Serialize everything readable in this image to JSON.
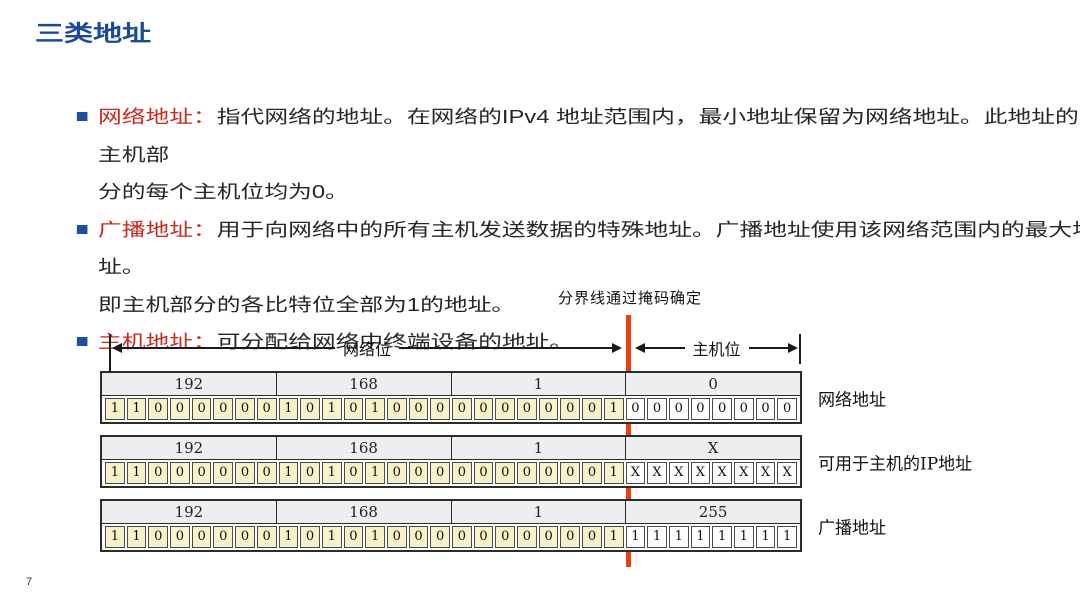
{
  "page": {
    "title": "三类地址",
    "page_number": "7"
  },
  "colors": {
    "title_blue": "#1B4A9B",
    "bullet_square_blue": "#1F4E9E",
    "term_red": "#C8281E",
    "divider_red": "#E8400F",
    "network_bit_yellow": "#F6F1C9",
    "octet_header_gray": "#EEEEF0"
  },
  "bullets": [
    {
      "label": "网络地址：",
      "lines": [
        "指代网络的地址。在网络的IPv4 地址范围内，最小地址保留为网络地址。此地址的主机部",
        "分的每个主机位均为0。"
      ]
    },
    {
      "label": "广播地址：",
      "lines": [
        "用于向网络中的所有主机发送数据的特殊地址。广播地址使用该网络范围内的最大地址。",
        "即主机部分的各比特位全部为1的地址。"
      ]
    },
    {
      "label": "主机地址：",
      "lines": [
        "可分配给网络中终端设备的地址。"
      ]
    }
  ],
  "diagram": {
    "divider_caption": "分界线通过掩码确定",
    "network_bits_label": "网络位",
    "host_bits_label": "主机位",
    "network_bit_count": 24,
    "rows": [
      {
        "octets": [
          "192",
          "168",
          "1",
          "0"
        ],
        "bits": [
          "11000000",
          "10101000",
          "00000001",
          "00000000"
        ],
        "label": "网络地址"
      },
      {
        "octets": [
          "192",
          "168",
          "1",
          "X"
        ],
        "bits": [
          "11000000",
          "10101000",
          "00000001",
          "XXXXXXXX"
        ],
        "label": "可用于主机的IP地址"
      },
      {
        "octets": [
          "192",
          "168",
          "1",
          "255"
        ],
        "bits": [
          "11000000",
          "10101000",
          "00000001",
          "11111111"
        ],
        "label": "广播地址"
      }
    ]
  }
}
